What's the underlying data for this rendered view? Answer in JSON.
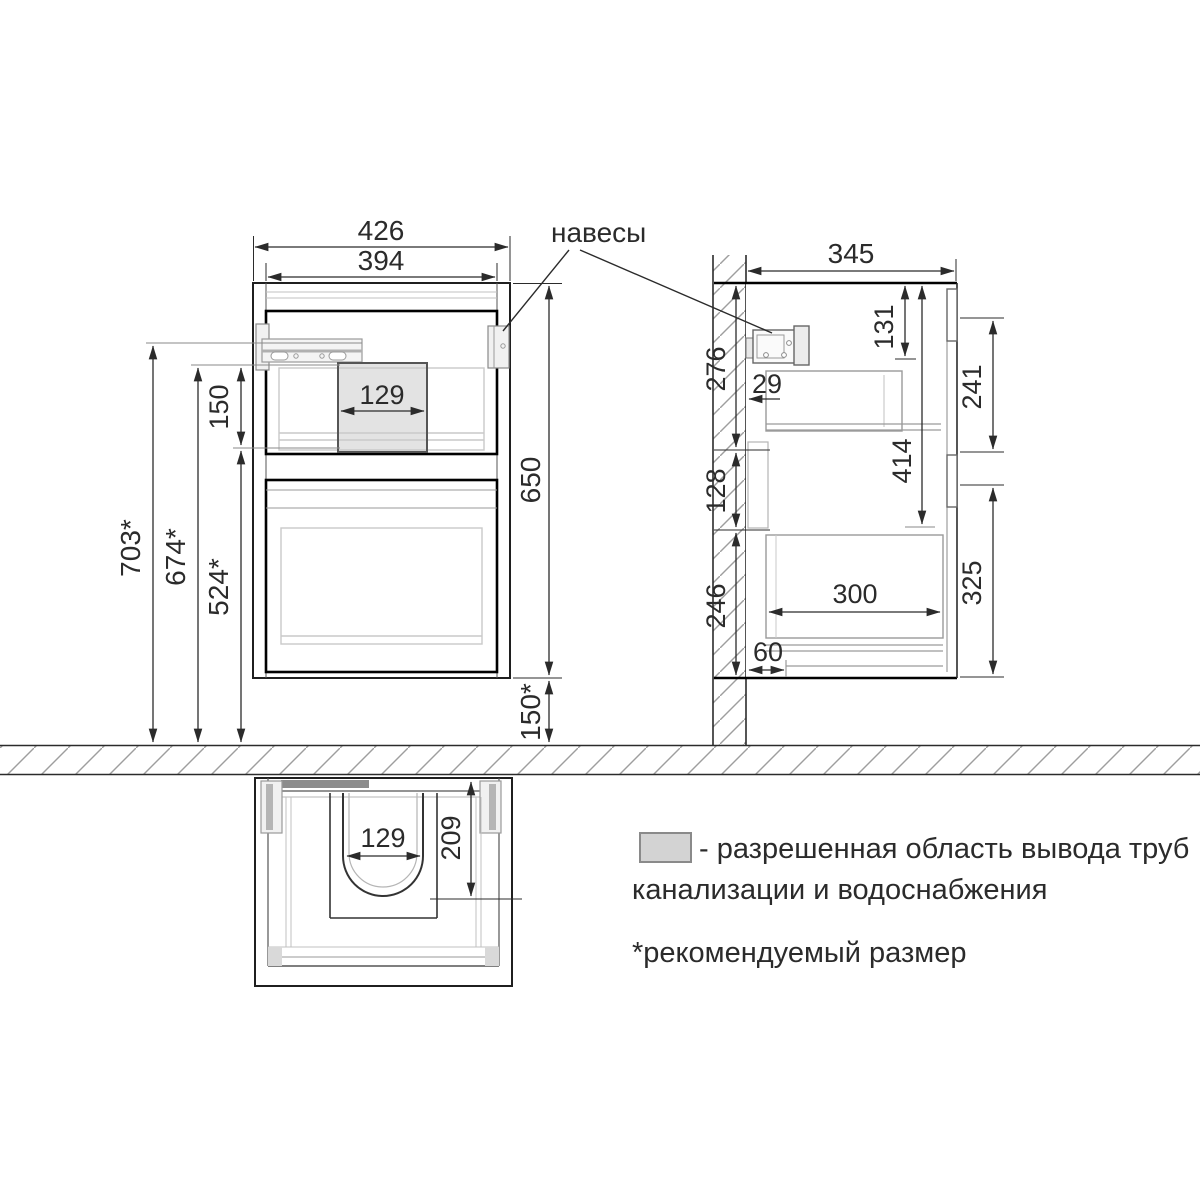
{
  "annotations": {
    "hangers_label": "навесы"
  },
  "front_view": {
    "overall_width": "426",
    "opening_width": "394",
    "pipe_zone_width": "129",
    "pipe_zone_height": "150",
    "cabinet_height": "650",
    "floor_clearance": "150*",
    "rail_height_from_floor": "703*",
    "pipe_zone_top_height": "674*",
    "pipe_zone_bottom_height": "524*"
  },
  "side_view": {
    "depth": "345",
    "hanger_drop": "131",
    "wall_top_zone": "276",
    "back_clearance": "29",
    "front_top_panel": "241",
    "drawer_top_drop": "414",
    "wall_pipe_zone": "128",
    "wall_bottom_zone": "246",
    "drawer_depth": "300",
    "front_bottom_panel": "325",
    "bottom_back_recess": "60"
  },
  "plan_view": {
    "trap_cutout_width": "129",
    "trap_cutout_depth": "209"
  },
  "legend": {
    "swatch_meaning_line1": "- разрешенная область вывода труб",
    "swatch_meaning_line2": "канализации и водоснабжения",
    "footnote": "*рекомендуемый размер"
  },
  "colors": {
    "line": "#2b2b2b",
    "bold_line": "#000000",
    "pipe_zone_fill": "#e3e3e3",
    "pipe_zone_border": "#555555",
    "hatch": "#9e9e9e",
    "plan_dark_bar": "#8c8c8c",
    "legend_swatch_fill": "#d3d3d3",
    "legend_swatch_border": "#8a8a8a"
  }
}
